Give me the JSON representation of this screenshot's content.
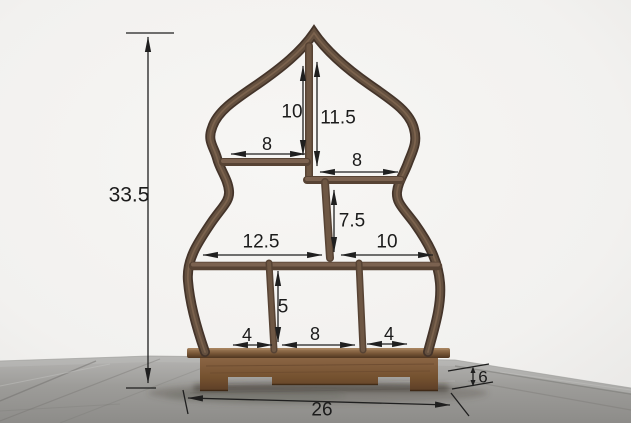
{
  "scene": {
    "subject": "gourd-shaped wooden display shelf on carved base",
    "setting": "light wall, gray wood-plank floor"
  },
  "dims": {
    "overall_height": "33.5",
    "top_left_height": "10",
    "top_right_height": "11.5",
    "top_left_width": "8",
    "top_right_width": "8",
    "mid_right_height": "7.5",
    "mid_left_width": "12.5",
    "mid_right_width": "10",
    "bottom_height": "5",
    "bottom_left_width": "4",
    "bottom_center_width": "8",
    "bottom_right_width": "4",
    "base_width": "26",
    "base_depth": "6"
  },
  "colors": {
    "wall": "#f5f4f2",
    "floor_light": "#b5b4b2",
    "floor_dark": "#8d8c89",
    "frame_wood_dark": "#44342a",
    "frame_wood_mid": "#64503f",
    "base_wood": "#84603f",
    "dimension_line": "#1f1f1f"
  }
}
